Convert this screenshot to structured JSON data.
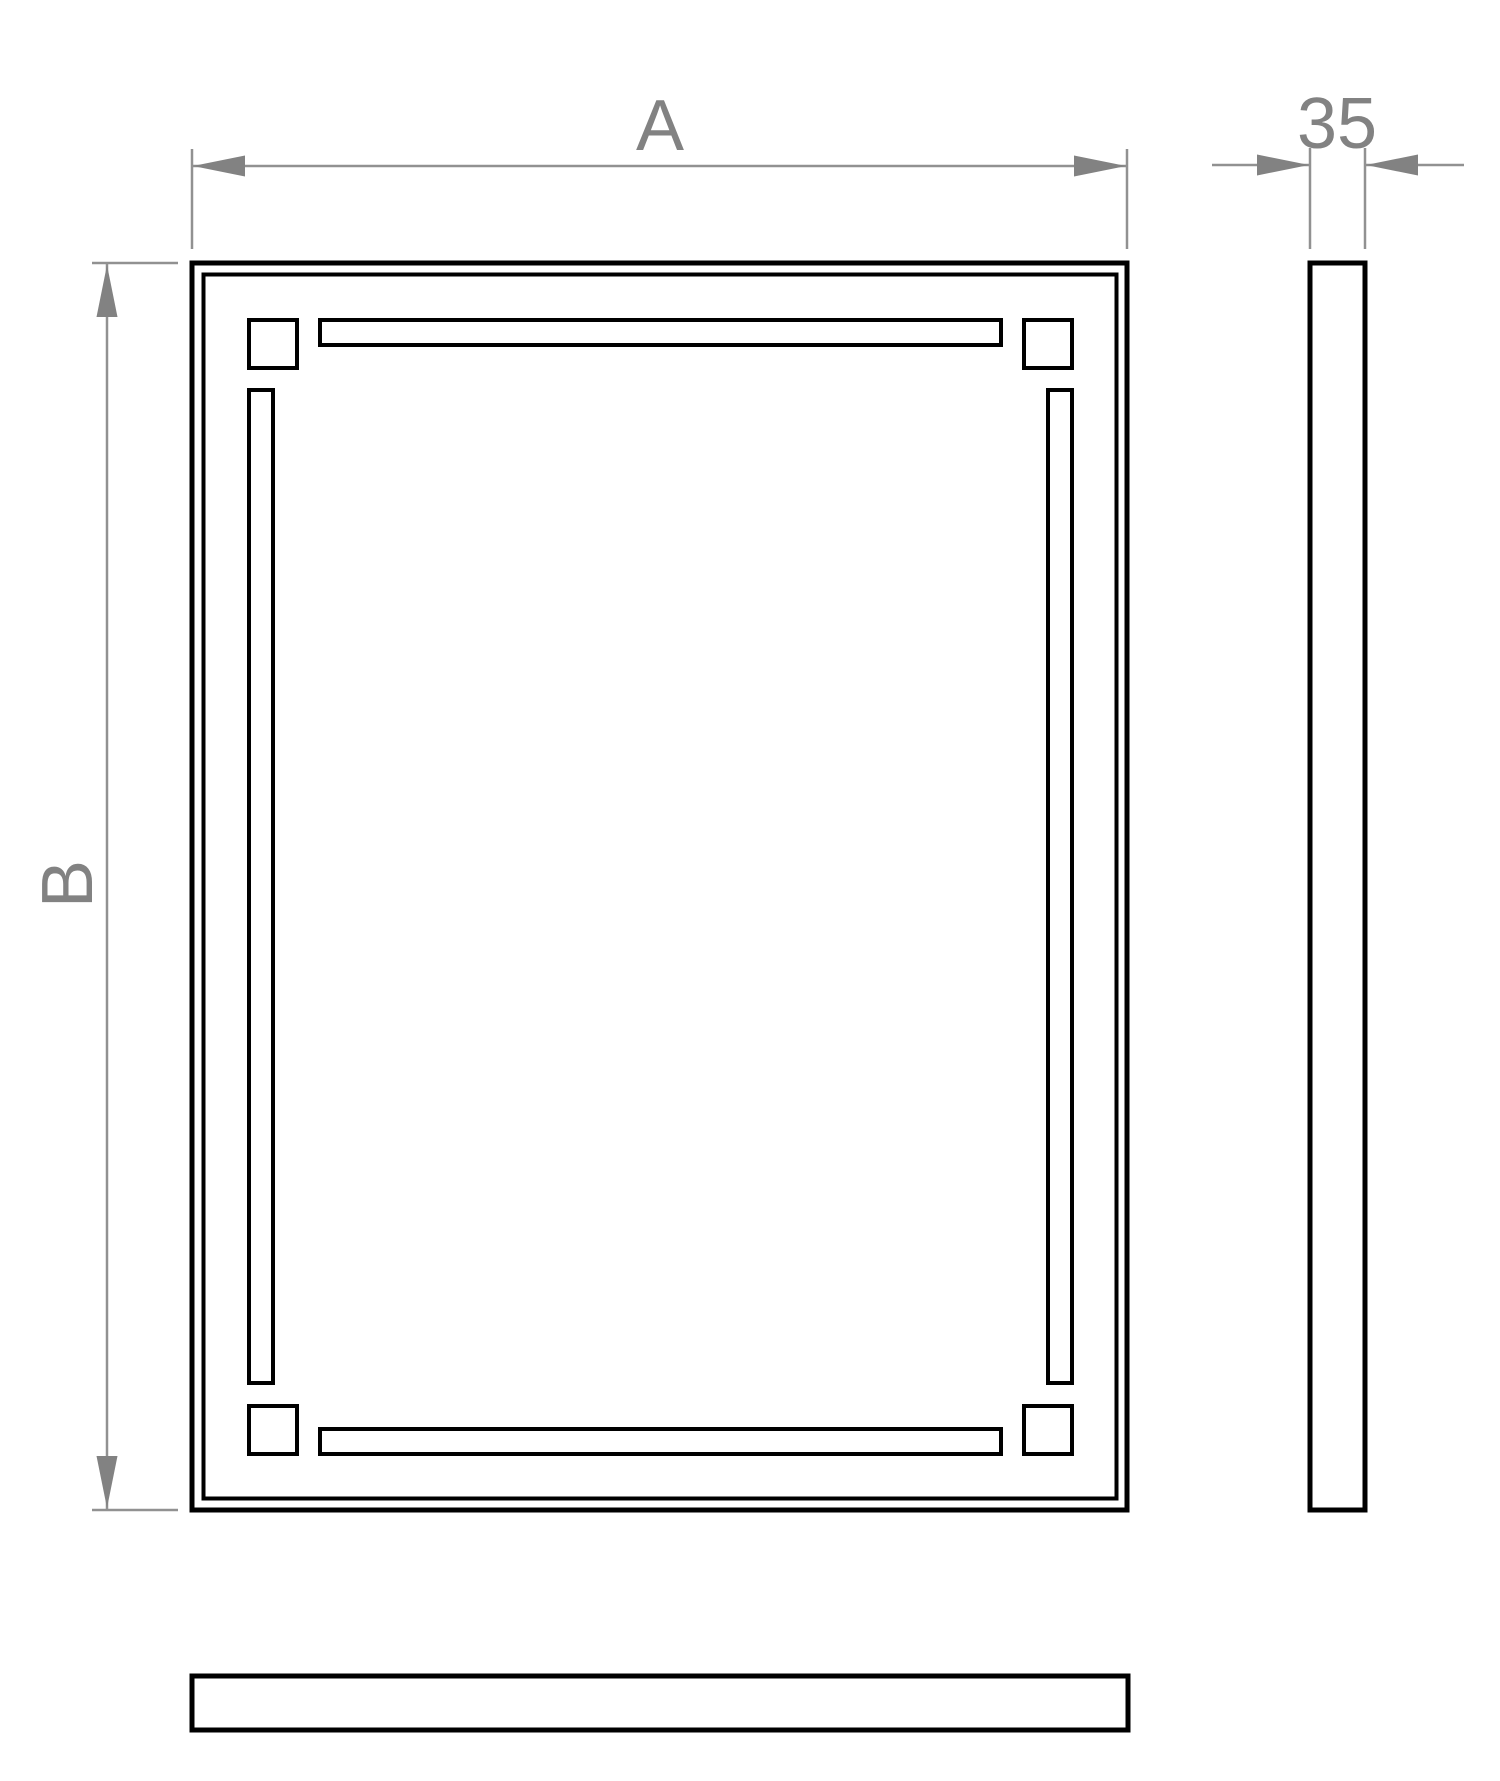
{
  "colors": {
    "outline": "#000000",
    "dimension_line": "#919191",
    "dimension_text": "#828282",
    "background": "#ffffff"
  },
  "dimensions": {
    "width": {
      "label": "A"
    },
    "height": {
      "label": "B"
    },
    "depth": {
      "label": "35"
    }
  }
}
